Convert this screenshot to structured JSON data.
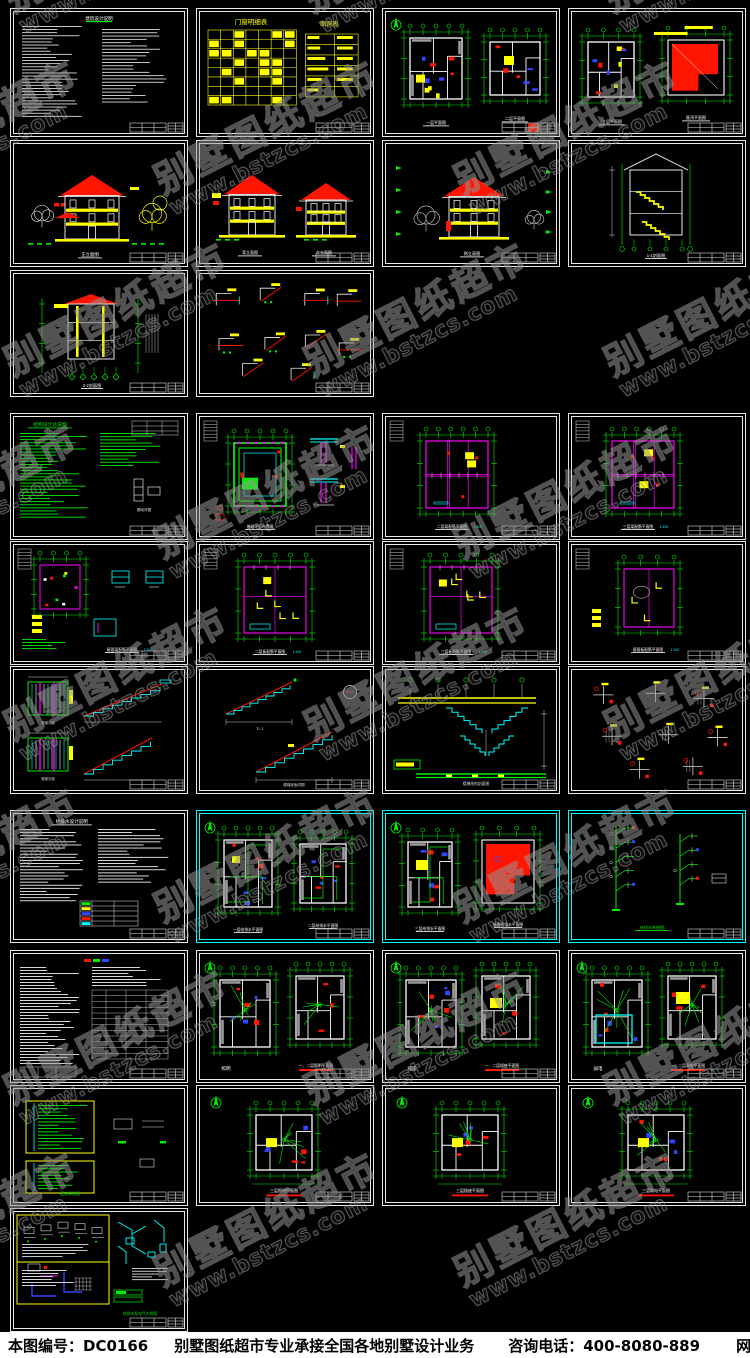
{
  "page": {
    "width": 750,
    "height": 1358,
    "background": "#000000",
    "description": "CAD 别墅施工图纸集合预览图"
  },
  "watermark": {
    "brand": "别墅图纸超市",
    "url": "www.bstzcs.com",
    "color": "#979797"
  },
  "footer": {
    "sheet_no": "本图编号：DC0166",
    "service": "别墅图纸超市专业承接全国各地别墅设计业务",
    "phone": "咨询电话：400-8080-889",
    "website": "网址：www.bstzcs.com",
    "background": "#ffffff",
    "text_color": "#000000"
  },
  "palette": {
    "background": "#000000",
    "frame_white": "#e8e8e8",
    "frame_cyan": "#00ffff",
    "green": "#00ee00",
    "yellow": "#ffff00",
    "red": "#ff1500",
    "cyan": "#00ffff",
    "magenta": "#ff00ff",
    "white": "#ffffff",
    "gray": "#b0b0b0",
    "blue": "#3344ff",
    "watermark_gray": "#979797"
  },
  "sheets": [
    {
      "id": "arch-notes",
      "row": 0,
      "col": 0,
      "kind": "notes_white",
      "border": "white",
      "title": "建筑设计说明"
    },
    {
      "id": "door-window-schedule",
      "row": 0,
      "col": 1,
      "kind": "tables_yellow",
      "border": "white",
      "title": "门窗明细表",
      "title2": "图例表"
    },
    {
      "id": "plan-1f-2f",
      "row": 0,
      "col": 2,
      "kind": "plan2",
      "border": "white",
      "title": "一层平面图",
      "title2": "二层平面图"
    },
    {
      "id": "plan-3f-roof",
      "row": 0,
      "col": 3,
      "kind": "plan_roof",
      "border": "white",
      "title": "三层平面图",
      "title2": "屋顶平面图"
    },
    {
      "id": "elev-front",
      "row": 1,
      "col": 0,
      "kind": "elev_front",
      "border": "white",
      "title": "正立面图"
    },
    {
      "id": "elev-back-left",
      "row": 1,
      "col": 1,
      "kind": "elev2",
      "border": "white",
      "title": "背立面图",
      "title2": "左立面图"
    },
    {
      "id": "elev-side",
      "row": 1,
      "col": 2,
      "kind": "elev_side",
      "border": "white",
      "title": "侧立面图"
    },
    {
      "id": "section-1-1",
      "row": 1,
      "col": 3,
      "kind": "section_stair",
      "border": "white",
      "title": "1-1剖面图"
    },
    {
      "id": "section-2-2",
      "row": 2,
      "col": 0,
      "kind": "section2",
      "border": "white",
      "title": "2-2剖面图"
    },
    {
      "id": "arch-details",
      "row": 2,
      "col": 1,
      "kind": "details_red",
      "border": "white",
      "title": "建筑节点详图"
    },
    {
      "id": "struct-notes",
      "row": 3,
      "col": 0,
      "kind": "notes_green",
      "border": "white",
      "title": "结构设计总说明"
    },
    {
      "id": "foundation-plan",
      "row": 3,
      "col": 1,
      "kind": "foundation",
      "border": "white",
      "title": "基础平面布置图"
    },
    {
      "id": "beam-plan-2f",
      "row": 3,
      "col": 2,
      "kind": "framing",
      "border": "white",
      "title": "二层梁配筋平面图",
      "scale_note": "1:100"
    },
    {
      "id": "beam-plan-3f",
      "row": 3,
      "col": 3,
      "kind": "framing",
      "border": "white",
      "title": "三层梁配筋平面图",
      "scale_note": "1:100"
    },
    {
      "id": "roof-beam-plan",
      "row": 4,
      "col": 0,
      "kind": "framing_small",
      "border": "white",
      "title": "屋面梁配筋平面图",
      "scale_note": "1:100"
    },
    {
      "id": "slab-plan-2f",
      "row": 4,
      "col": 1,
      "kind": "slab",
      "border": "white",
      "title": "二层板配筋平面图",
      "scale_note": "1:100"
    },
    {
      "id": "slab-plan-3f",
      "row": 4,
      "col": 2,
      "kind": "slab",
      "border": "white",
      "title": "三层板配筋平面图",
      "scale_note": "1:100"
    },
    {
      "id": "roof-slab-plan",
      "row": 4,
      "col": 3,
      "kind": "slab_small",
      "border": "white",
      "title": "屋面板配筋平面图",
      "scale_note": "1:100"
    },
    {
      "id": "stair-plan-details",
      "row": 5,
      "col": 0,
      "kind": "stair_plans",
      "border": "white",
      "title": "楼梯平面详图"
    },
    {
      "id": "stair-section-details",
      "row": 5,
      "col": 1,
      "kind": "stair_sections",
      "border": "white",
      "title": "楼梯剖面详图"
    },
    {
      "id": "stair-structure",
      "row": 5,
      "col": 2,
      "kind": "stair_elev",
      "border": "white",
      "title": "楼梯结构剖面图"
    },
    {
      "id": "struct-node-details",
      "row": 5,
      "col": 3,
      "kind": "nodes_mixed",
      "border": "white",
      "title": "结构节点详图"
    },
    {
      "id": "plumbing-notes",
      "row": 6,
      "col": 0,
      "kind": "plumb_notes",
      "border": "white",
      "title": "给排水设计说明"
    },
    {
      "id": "plumbing-plan-1f-2f",
      "row": 6,
      "col": 1,
      "kind": "plumb2",
      "border": "cyan",
      "title": "一层给排水平面图",
      "title2": "二层给排水平面图"
    },
    {
      "id": "plumbing-plan-3f-roof",
      "row": 6,
      "col": 2,
      "kind": "plumb_roof",
      "border": "cyan",
      "title": "三层给排水平面图",
      "title2": "屋面给排水平面图"
    },
    {
      "id": "plumbing-risers",
      "row": 6,
      "col": 3,
      "kind": "risers",
      "border": "cyan",
      "title": "给排水系统图"
    },
    {
      "id": "electrical-notes",
      "row": 7,
      "col": 0,
      "kind": "elec_notes",
      "border": "white",
      "title": "电气设计说明"
    },
    {
      "id": "lighting-plan-1f-2f",
      "row": 7,
      "col": 1,
      "kind": "elec2",
      "border": "white",
      "title": "照明",
      "title2": "一、二层照明平面图"
    },
    {
      "id": "socket-plan-1f-2f",
      "row": 7,
      "col": 2,
      "kind": "elec2",
      "border": "white",
      "title": "插座",
      "title2": "一、二层插座平面图",
      "accent": "yellow"
    },
    {
      "id": "telecom-plan-1f-2f",
      "row": 7,
      "col": 3,
      "kind": "elec2",
      "border": "white",
      "title": "弱电",
      "title2": "一、二层弱电平面图",
      "accent": "cyan"
    },
    {
      "id": "power-system",
      "row": 8,
      "col": 0,
      "kind": "elec_sys",
      "border": "white",
      "title": "配电系统图"
    },
    {
      "id": "lighting-plan-3f",
      "row": 8,
      "col": 1,
      "kind": "plan1",
      "border": "white",
      "title": "三层照明平面图"
    },
    {
      "id": "socket-plan-3f",
      "row": 8,
      "col": 2,
      "kind": "plan1",
      "border": "white",
      "title": "三层插座平面图"
    },
    {
      "id": "telecom-plan-3f",
      "row": 8,
      "col": 3,
      "kind": "plan1",
      "border": "white",
      "title": "三层弱电平面图"
    },
    {
      "id": "mep-details",
      "row": 9,
      "col": 0,
      "kind": "detail_quad",
      "border": "white",
      "title": "给排水及电气大样图"
    }
  ]
}
